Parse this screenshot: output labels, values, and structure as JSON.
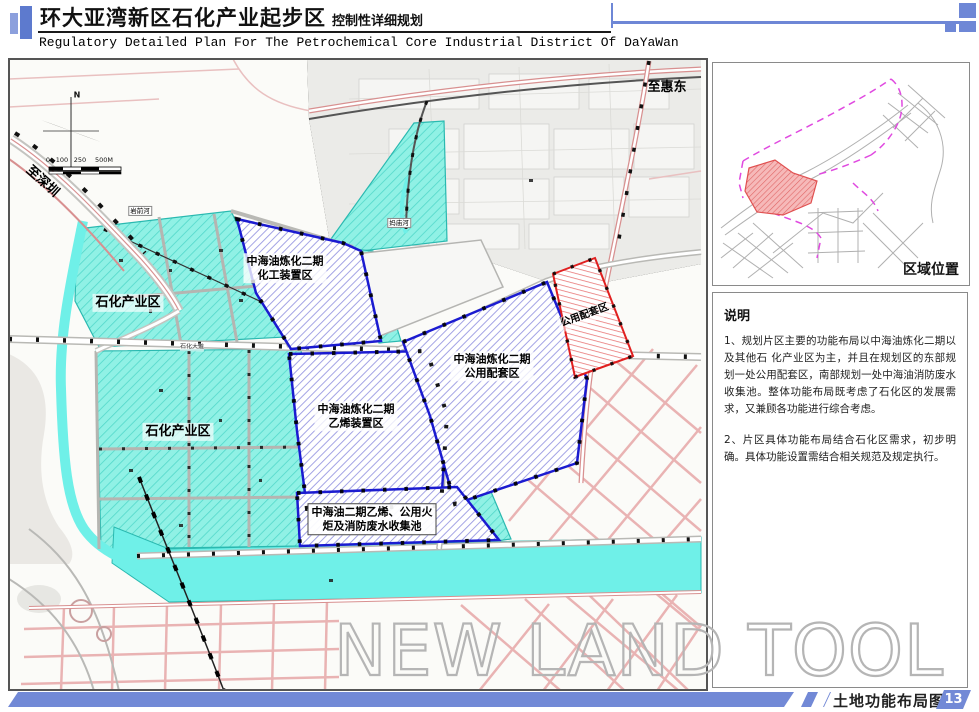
{
  "header": {
    "title_zh": "环大亚湾新区石化产业起步区",
    "title_suffix": "控制性详细规划",
    "title_en": "Regulatory Detailed Plan For The Petrochemical Core Industrial District Of DaYaWan"
  },
  "map": {
    "compass_n": "N",
    "scale_labels": [
      "0",
      "100",
      "250",
      "500M"
    ],
    "direction_labels": {
      "shenzhen": "至深圳",
      "huidong": "至惠东"
    },
    "river_labels": {
      "yanqian": "岩前河",
      "mamiao": "妈庙河"
    },
    "road_label": "石化大道",
    "regions": {
      "petro_upper": {
        "label": "石化产业区"
      },
      "petro_lower": {
        "label": "石化产业区"
      },
      "chemical": {
        "line1": "中海油炼化二期",
        "line2": "化工装置区"
      },
      "ethylene": {
        "line1": "中海油炼化二期",
        "line2": "乙烯装置区"
      },
      "utility_main": {
        "line1": "中海油炼化二期",
        "line2": "公用配套区"
      },
      "utility_east": {
        "label": "公用配套区"
      },
      "pool": {
        "line1": "中海油二期乙烯、公用火",
        "line2": "炬及消防废水收集池"
      }
    },
    "watermark": "NEW LAND TOOL"
  },
  "sidebar": {
    "location_title": "区域位置",
    "notes": {
      "title": "说明",
      "para1": "1、规划片区主要的功能布局以中海油炼化二期以及其他石 化产业区为主，并且在规划区的东部规划一处公用配套区，南部规划一处中海油消防废水收集池。整体功能布局既考虑了石化区的发展需求，又兼顾各功能进行综合考虑。",
      "para2": "2、片区具体功能布局结合石化区需求，初步明确。具体功能设置需结合相关规范及规定执行。"
    }
  },
  "footer": {
    "doc_label": "土地功能布局图",
    "page_number": "13"
  },
  "colors": {
    "accent_blue": "#6e87d6",
    "region_blue_border": "#1b1bd0",
    "region_red": "#e02020",
    "cyan_fill": "#8df1e6"
  }
}
